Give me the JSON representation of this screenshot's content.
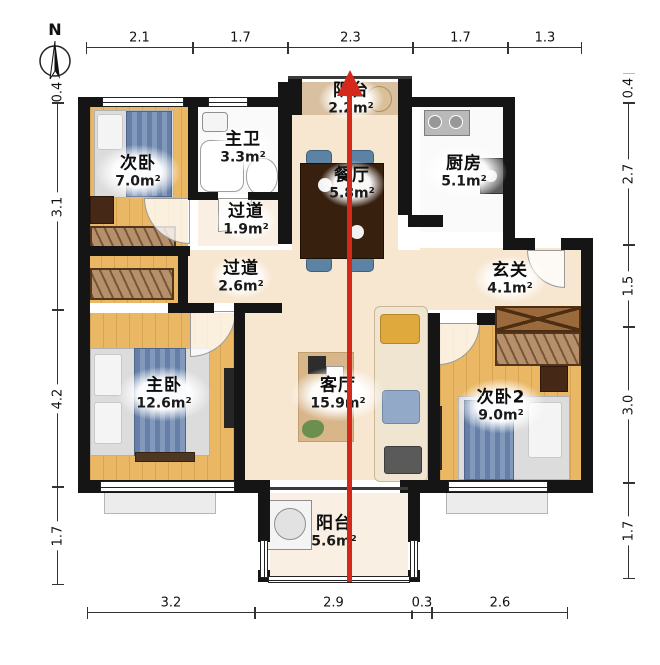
{
  "compass": {
    "label": "N"
  },
  "rooms": [
    {
      "name": "次卧",
      "area": "7.0m²"
    },
    {
      "name": "主卫",
      "area": "3.3m²"
    },
    {
      "name": "阳台",
      "area": "2.2m²"
    },
    {
      "name": "餐厅",
      "area": "5.8m²"
    },
    {
      "name": "厨房",
      "area": "5.1m²"
    },
    {
      "name": "过道",
      "area": "1.9m²"
    },
    {
      "name": "过道",
      "area": "2.6m²"
    },
    {
      "name": "玄关",
      "area": "4.1m²"
    },
    {
      "name": "主卧",
      "area": "12.6m²"
    },
    {
      "name": "客厅",
      "area": "15.9m²"
    },
    {
      "name": "次卧2",
      "area": "9.0m²"
    },
    {
      "name": "阳台",
      "area": "5.6m²"
    }
  ],
  "dimensions": {
    "top": [
      "2.1",
      "1.7",
      "2.3",
      "1.7",
      "1.3"
    ],
    "bottom": [
      "3.2",
      "2.9",
      "0.3",
      "2.6"
    ],
    "left": [
      "0.4",
      "3.1",
      "4.2",
      "1.7"
    ],
    "right": [
      "0.4",
      "2.7",
      "1.5",
      "3.0",
      "1.7"
    ]
  },
  "colors": {
    "wall": "#151515",
    "arrow": "#d6281a",
    "wood_floor": "#eab764",
    "cream_floor": "#f7e7d1",
    "blanket_blue": "#657fa6"
  }
}
